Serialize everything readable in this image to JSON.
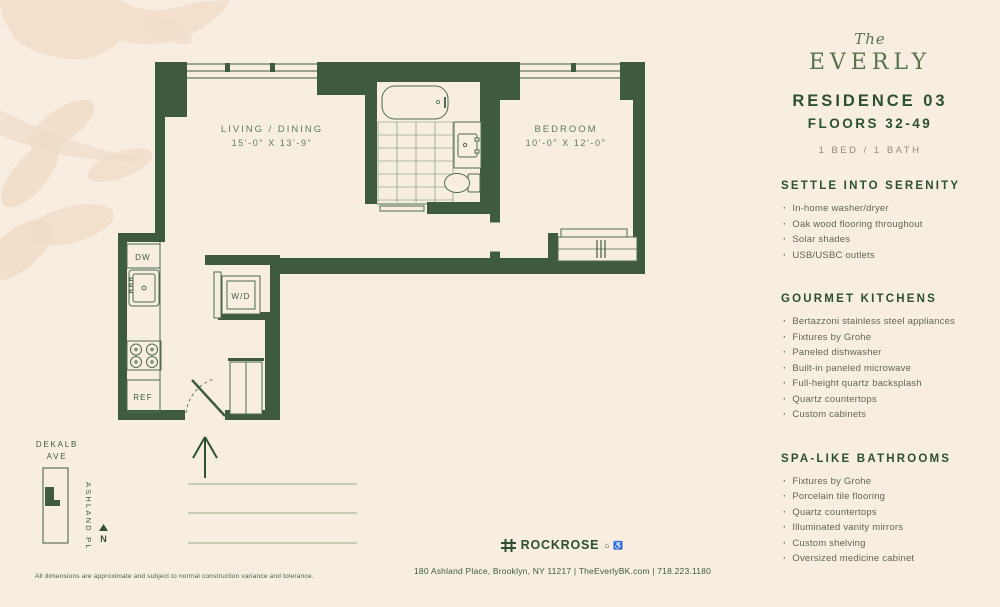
{
  "sidebar": {
    "bullet": "·",
    "logo": {
      "the": "The",
      "name": "EVERLY"
    },
    "residence": "RESIDENCE 03",
    "floors": "FLOORS 32-49",
    "config": "1 BED / 1 BATH",
    "sections": [
      {
        "title": "SETTLE INTO SERENITY",
        "items": [
          "In-home washer/dryer",
          "Oak wood flooring throughout",
          "Solar shades",
          "USB/USBC outlets"
        ]
      },
      {
        "title": "GOURMET KITCHENS",
        "items": [
          "Bertazzoni stainless steel appliances",
          "Fixtures by Grohe",
          "Paneled dishwasher",
          "Built-in paneled microwave",
          "Full-height quartz backsplash",
          "Quartz countertops",
          "Custom cabinets"
        ]
      },
      {
        "title": "SPA-LIKE BATHROOMS",
        "items": [
          "Fixtures by Grohe",
          "Porcelain tile flooring",
          "Quartz countertops",
          "Illuminated vanity mirrors",
          "Custom shelving",
          "Oversized medicine cabinet"
        ]
      }
    ]
  },
  "floorplan": {
    "living": {
      "label": "LIVING / DINING",
      "dims": "15'-0\" X 13'-9\""
    },
    "bedroom": {
      "label": "BEDROOM",
      "dims": "10'-0\" X 12'-0\""
    },
    "appliances": {
      "dw": "DW",
      "wd": "W/D",
      "ref": "REF"
    }
  },
  "map": {
    "street1": "DEKALB",
    "street1b": "AVE",
    "street2": "ASHLAND PL",
    "north": "N"
  },
  "footer": {
    "disclaimer": "All dimensions are approximate and subject to normal construction variance and tolerance.",
    "brand": "ROCKROSE",
    "brand_icons": "⌂ ♿",
    "address": "180 Ashland Place, Brooklyn, NY 11217 | TheEverlyBK.com | 718.223.1180"
  },
  "colors": {
    "wall_green": "#3e5a40",
    "heading_green": "#2c4f35",
    "background_cream": "#f7eee1",
    "watermark": "#f0dcc8"
  }
}
